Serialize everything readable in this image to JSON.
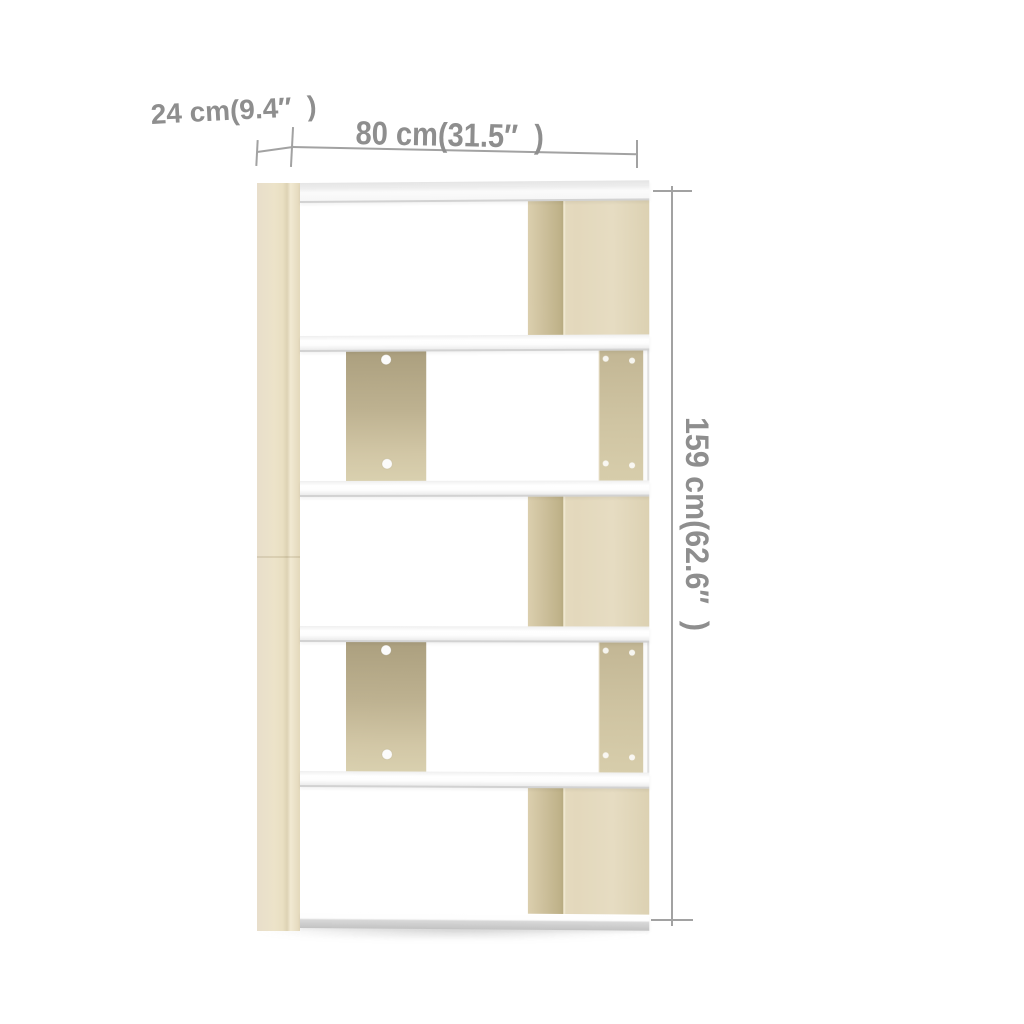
{
  "figure": {
    "type": "product-dimension-image",
    "labels": {
      "depth": "24 cm(9.4″  )",
      "width": "80 cm(31.5″  )",
      "height": "159 cm(62.6″  )"
    },
    "colors": {
      "background": "#ffffff",
      "oak_light": "#e4dabf",
      "oak_shadow": "#c3b68e",
      "shelf_white": "#fbfbfb",
      "shelf_edge_gray": "#c9c9c9",
      "dimension_line": "#a2a2a2",
      "dimension_text": "#8e8e8e"
    },
    "structure": {
      "sections": 5,
      "shelf_boards": 6,
      "screw_caps_per_divider": 2
    }
  }
}
